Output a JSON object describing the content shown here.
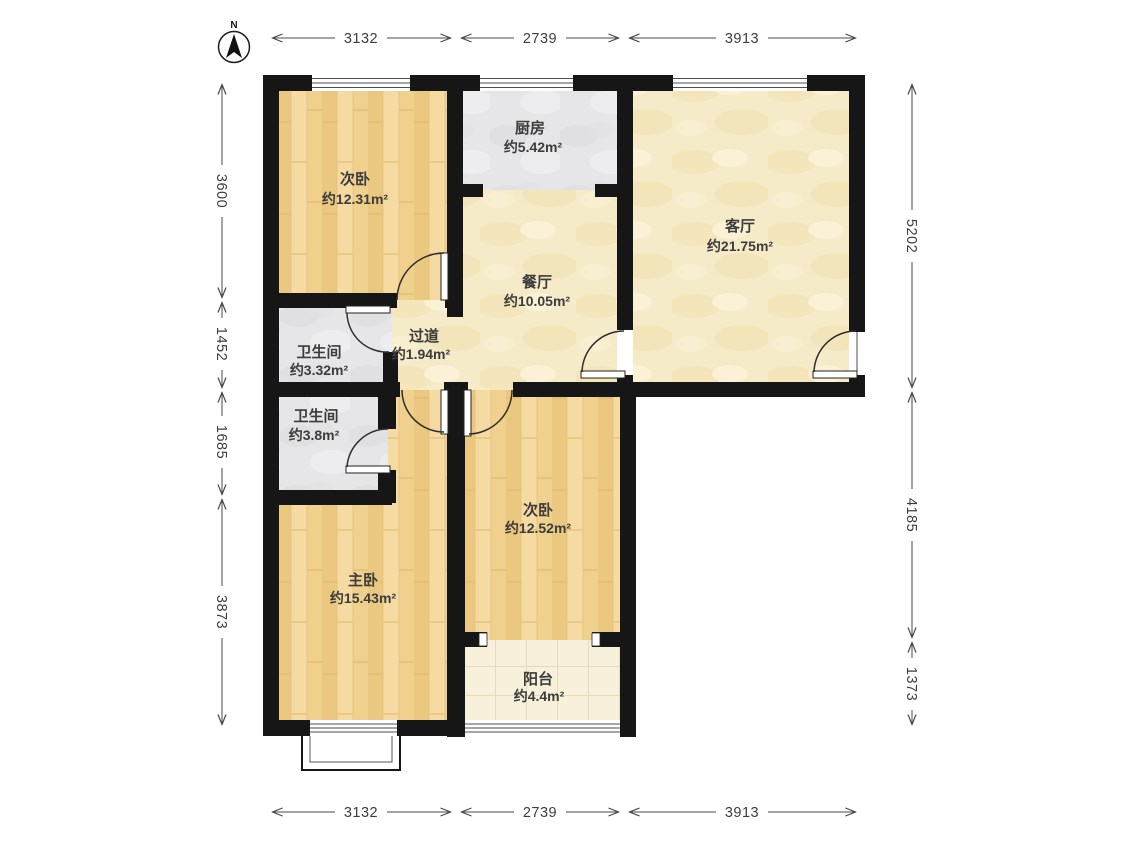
{
  "compass": {
    "label": "N"
  },
  "rooms": {
    "bedroom_top": {
      "name": "次卧",
      "area": "约12.31m²"
    },
    "kitchen": {
      "name": "厨房",
      "area": "约5.42m²"
    },
    "living": {
      "name": "客厅",
      "area": "约21.75m²"
    },
    "dining": {
      "name": "餐厅",
      "area": "约10.05m²"
    },
    "hallway": {
      "name": "过道",
      "area": "约1.94m²"
    },
    "bath_upper": {
      "name": "卫生间",
      "area": "约3.32m²"
    },
    "bath_lower": {
      "name": "卫生间",
      "area": "约3.8m²"
    },
    "master": {
      "name": "主卧",
      "area": "约15.43m²"
    },
    "bedroom_bottom": {
      "name": "次卧",
      "area": "约12.52m²"
    },
    "balcony": {
      "name": "阳台",
      "area": "约4.4m²"
    }
  },
  "dimensions": {
    "top": [
      "3132",
      "2739",
      "3913"
    ],
    "bottom": [
      "3132",
      "2739",
      "3913"
    ],
    "left": [
      "3600",
      "1452",
      "1685",
      "3873"
    ],
    "right": [
      "5202",
      "4185",
      "1373"
    ]
  },
  "colors": {
    "wall": "#161616",
    "wood_floor": "#f1d293",
    "gray_tile": "#e6e6e8",
    "marble_cream": "#f6ebc9",
    "balcony_tile": "#f7f0da",
    "dimension": "#4a4a4a"
  }
}
